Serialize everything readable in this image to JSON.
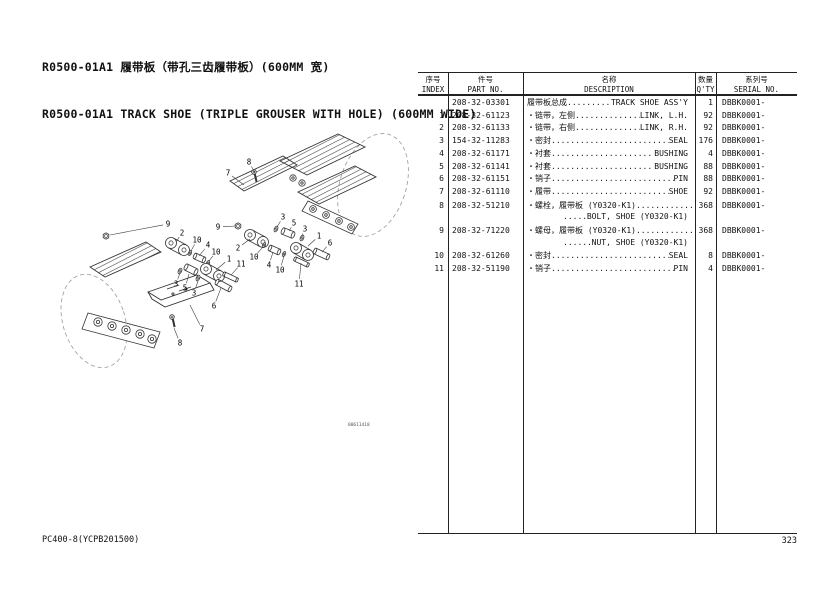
{
  "page": {
    "title_cn": "R0500-01A1 履带板（带孔三齿履带板）(600MM 宽)",
    "title_en": "R0500-01A1 TRACK SHOE (TRIPLE GROUSER WITH HOLE) (600MM WIDE)",
    "footer_left": "PC400-8(YCPB201500)",
    "page_number": "323"
  },
  "diagram": {
    "figure_id": "00611418",
    "callouts": [
      {
        "label": "8",
        "tx": 209,
        "ty": 77,
        "px": 215,
        "py": 88
      },
      {
        "label": "7",
        "tx": 188,
        "ty": 88,
        "px": 204,
        "py": 100
      },
      {
        "label": "9",
        "tx": 178,
        "ty": 142,
        "px": 195,
        "py": 141
      },
      {
        "label": "2",
        "tx": 198,
        "ty": 163,
        "px": 210,
        "py": 154
      },
      {
        "label": "3",
        "tx": 243,
        "ty": 132,
        "px": 237,
        "py": 142
      },
      {
        "label": "5",
        "tx": 254,
        "ty": 138,
        "px": 249,
        "py": 146
      },
      {
        "label": "3",
        "tx": 265,
        "ty": 144,
        "px": 262,
        "py": 151
      },
      {
        "label": "1",
        "tx": 279,
        "ty": 151,
        "px": 268,
        "py": 161
      },
      {
        "label": "6",
        "tx": 290,
        "ty": 158,
        "px": 282,
        "py": 167
      },
      {
        "label": "10",
        "tx": 214,
        "ty": 172,
        "px": 223,
        "py": 162
      },
      {
        "label": "4",
        "tx": 229,
        "ty": 180,
        "px": 233,
        "py": 167
      },
      {
        "label": "10",
        "tx": 240,
        "ty": 185,
        "px": 244,
        "py": 171
      },
      {
        "label": "11",
        "tx": 259,
        "ty": 199,
        "px": 261,
        "py": 178
      },
      {
        "label": "9",
        "tx": 128,
        "ty": 139,
        "px": 70,
        "py": 150
      },
      {
        "label": "2",
        "tx": 142,
        "ty": 148,
        "px": 136,
        "py": 157
      },
      {
        "label": "10",
        "tx": 157,
        "ty": 155,
        "px": 151,
        "py": 166
      },
      {
        "label": "4",
        "tx": 168,
        "ty": 160,
        "px": 159,
        "py": 171
      },
      {
        "label": "10",
        "tx": 176,
        "ty": 167,
        "px": 169,
        "py": 176
      },
      {
        "label": "1",
        "tx": 189,
        "ty": 174,
        "px": 176,
        "py": 185
      },
      {
        "label": "11",
        "tx": 201,
        "ty": 179,
        "px": 191,
        "py": 190
      },
      {
        "label": "3",
        "tx": 136,
        "ty": 199,
        "px": 140,
        "py": 188
      },
      {
        "label": "5",
        "tx": 145,
        "ty": 203,
        "px": 149,
        "py": 189
      },
      {
        "label": "3",
        "tx": 154,
        "ty": 208,
        "px": 158,
        "py": 196
      },
      {
        "label": "6",
        "tx": 174,
        "ty": 221,
        "px": 181,
        "py": 203
      },
      {
        "label": "7",
        "tx": 162,
        "ty": 244,
        "px": 150,
        "py": 220
      },
      {
        "label": "8",
        "tx": 140,
        "ty": 258,
        "px": 134,
        "py": 243
      }
    ]
  },
  "table": {
    "headers": {
      "index": {
        "cn": "序号",
        "en": "INDEX"
      },
      "part": {
        "cn": "件号",
        "en": "PART NO."
      },
      "desc": {
        "cn": "名称",
        "en": "DESCRIPTION"
      },
      "qty": {
        "cn": "数量",
        "en": "Q'TY"
      },
      "serial": {
        "cn": "系列号",
        "en": "SERIAL NO."
      }
    },
    "rows": [
      {
        "index": "",
        "part": "208-32-03301",
        "cn": "履带板总成",
        "en": "TRACK SHOE ASS'Y",
        "qty": "1",
        "serial": "DBBK0001-",
        "two_line": false
      },
      {
        "index": "1",
        "part": "208-32-61123",
        "cn": "・链带，左侧",
        "en": "LINK, L.H.",
        "qty": "92",
        "serial": "DBBK0001-",
        "two_line": false
      },
      {
        "index": "2",
        "part": "208-32-61133",
        "cn": "・链带，右侧",
        "en": "LINK, R.H.",
        "qty": "92",
        "serial": "DBBK0001-",
        "two_line": false
      },
      {
        "index": "3",
        "part": "154-32-11283",
        "cn": "・密封",
        "en": "SEAL",
        "qty": "176",
        "serial": "DBBK0001-",
        "two_line": false
      },
      {
        "index": "4",
        "part": "208-32-61171",
        "cn": "・衬套",
        "en": "BUSHING",
        "qty": "4",
        "serial": "DBBK0001-",
        "two_line": false
      },
      {
        "index": "5",
        "part": "208-32-61141",
        "cn": "・衬套",
        "en": "BUSHING",
        "qty": "88",
        "serial": "DBBK0001-",
        "two_line": false
      },
      {
        "index": "6",
        "part": "208-32-61151",
        "cn": "・销子",
        "en": "PIN",
        "qty": "88",
        "serial": "DBBK0001-",
        "two_line": false
      },
      {
        "index": "7",
        "part": "208-32-61110",
        "cn": "・履带",
        "en": "SHOE",
        "qty": "92",
        "serial": "DBBK0001-",
        "two_line": false
      },
      {
        "index": "8",
        "part": "208-32-51210",
        "cn": "・螺栓，履带板 (Y0320-K1)",
        "en": "BOLT, SHOE (Y0320-K1)",
        "qty": "368",
        "serial": "DBBK0001-",
        "two_line": true
      },
      {
        "index": "9",
        "part": "208-32-71220",
        "cn": "・螺母，履带板 (Y0320-K1)",
        "en": "NUT, SHOE (Y0320-K1)",
        "qty": "368",
        "serial": "DBBK0001-",
        "two_line": true
      },
      {
        "index": "10",
        "part": "208-32-61260",
        "cn": "・密封",
        "en": "SEAL",
        "qty": "8",
        "serial": "DBBK0001-",
        "two_line": false
      },
      {
        "index": "11",
        "part": "208-32-51190",
        "cn": "・销子",
        "en": "PIN",
        "qty": "4",
        "serial": "DBBK0001-",
        "two_line": false
      }
    ]
  }
}
